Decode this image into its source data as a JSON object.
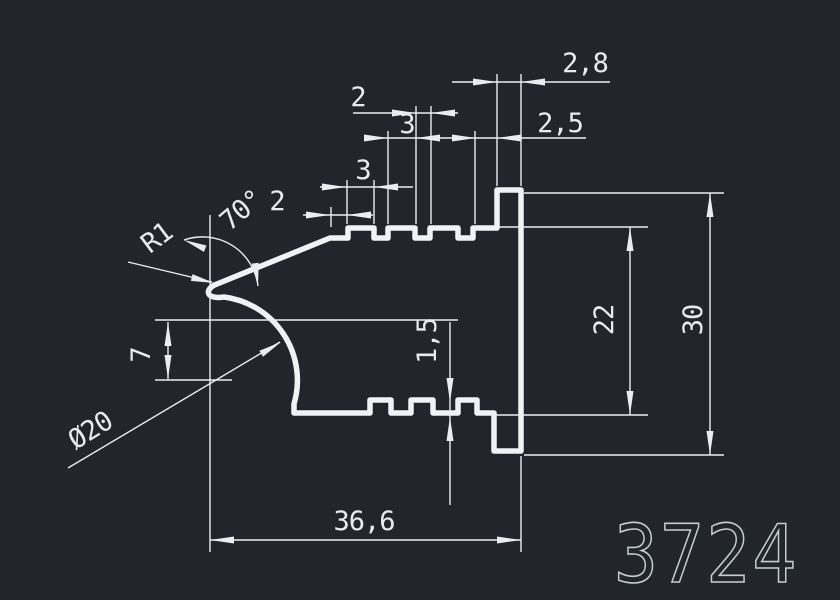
{
  "canvas": {
    "background": "#22262c",
    "profile_line_color": "#f0f3f5",
    "dimension_color": "#e9edf0",
    "part_number_color": "#c6ccd2"
  },
  "drawing": {
    "type": "cad-profile-cross-section",
    "part_number": "3724",
    "dimensions": {
      "top_flat_width": "2",
      "tooth1_width": "3",
      "notch_width": "2",
      "tooth2_width": "3",
      "tooth4_width": "2,5",
      "step_width": "2,8",
      "angle": "70°",
      "tip_radius": "R1",
      "center_offset": "7",
      "arc_diameter": "Ø20",
      "groove_depth": "1,5",
      "inner_height": "22",
      "overall_height": "30",
      "overall_width": "36,6"
    }
  }
}
